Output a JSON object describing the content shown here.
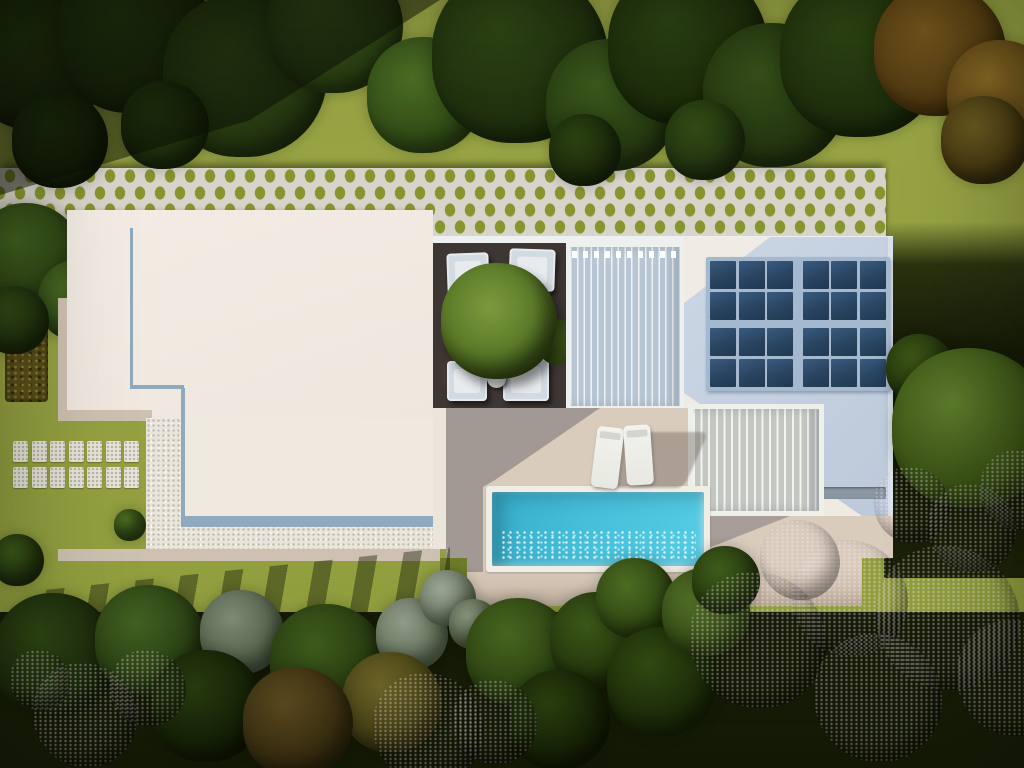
{
  "scene": {
    "description": "Aerial top-down 3D render of a modern flat-roof villa with breeze-block fence, shaded courtyard, slatted pergolas, rooftop solar array, swimming pool with sun loungers, stepping-stone path and landscaped garden with flowering trees",
    "canvas": {
      "width": 1024,
      "height": 768
    },
    "palette": {
      "lawn": "#96a240",
      "lattice": "#d8d4cb",
      "roof_white": "#f1eae1",
      "roof_blue": "#c3cfde",
      "accent": "#8fa9be",
      "solar": "#2c4a69",
      "courtyard": "#3e3633",
      "terrace": "#d9ccbd",
      "terrace_shadow": "#a8a2a7",
      "pool": "#46bfda",
      "coping": "#efede4",
      "gravel": "#e9e5db",
      "beige": "#cfc1b1",
      "blossom": "#cba5c1",
      "sage": "#8e9887",
      "autumn": "#7d5c20"
    },
    "solar_array": {
      "rows": 4,
      "cols": 6,
      "pad": 4,
      "gap": 2.5,
      "center_gap_x": 7,
      "center_gap_y": 6
    },
    "stepping_stones": {
      "rows": 2,
      "cols": 7,
      "cell_w": 15,
      "cell_h": 21,
      "gap_x": 3.5,
      "gap_y": 5
    },
    "furniture": {
      "courtyard_sofas": 4,
      "side_tables": 2,
      "sun_loungers": 2
    },
    "trees": {
      "top": [
        {
          "x": 38,
          "y": 58,
          "r": 72,
          "c": "#2a4012",
          "e": "#16230a"
        },
        {
          "x": 135,
          "y": 35,
          "r": 78,
          "c": "#2e4614",
          "e": "#19270c"
        },
        {
          "x": 245,
          "y": 75,
          "r": 82,
          "c": "#3a5519",
          "e": "#20310f"
        },
        {
          "x": 335,
          "y": 25,
          "r": 68,
          "c": "#42601e",
          "e": "#263a11"
        },
        {
          "x": 425,
          "y": 95,
          "r": 58,
          "c": "#4d7024",
          "e": "#2c4414"
        },
        {
          "x": 520,
          "y": 55,
          "r": 88,
          "c": "#304815",
          "e": "#1b2b0c"
        },
        {
          "x": 612,
          "y": 105,
          "r": 66,
          "c": "#3c5a1c",
          "e": "#223410"
        },
        {
          "x": 688,
          "y": 45,
          "r": 80,
          "c": "#2c4413",
          "e": "#182708"
        },
        {
          "x": 775,
          "y": 95,
          "r": 72,
          "c": "#37511a",
          "e": "#1f2f0e"
        },
        {
          "x": 862,
          "y": 55,
          "r": 82,
          "c": "#2f4714",
          "e": "#1a290b"
        },
        {
          "x": 940,
          "y": 50,
          "r": 66,
          "c": "#7b5a1e",
          "e": "#4a340f"
        },
        {
          "x": 1002,
          "y": 95,
          "r": 55,
          "c": "#8a6a26",
          "e": "#523c12"
        },
        {
          "x": 60,
          "y": 140,
          "r": 48,
          "c": "#24390f",
          "e": "#131d07"
        },
        {
          "x": 165,
          "y": 125,
          "r": 44,
          "c": "#2d4512",
          "e": "#18260a"
        },
        {
          "x": 585,
          "y": 150,
          "r": 36,
          "c": "#2b4212",
          "e": "#18260a"
        },
        {
          "x": 705,
          "y": 140,
          "r": 40,
          "c": "#334c16",
          "e": "#1d2d0d"
        },
        {
          "x": 985,
          "y": 140,
          "r": 44,
          "c": "#6b5a20",
          "e": "#3c300e"
        }
      ],
      "left": [
        {
          "x": 28,
          "y": 258,
          "r": 55,
          "c": "#41601f",
          "e": "#253a10"
        },
        {
          "x": 78,
          "y": 300,
          "r": 40,
          "c": "#4a6c24",
          "e": "#2a4013"
        },
        {
          "x": 15,
          "y": 320,
          "r": 34,
          "c": "#314a16",
          "e": "#1c2c0c"
        },
        {
          "x": 130,
          "y": 525,
          "r": 16,
          "c": "#4e7024",
          "e": "#2c4413"
        },
        {
          "x": 18,
          "y": 560,
          "r": 26,
          "c": "#3c5a1a",
          "e": "#20300d"
        }
      ],
      "right": [
        {
          "x": 920,
          "y": 368,
          "r": 34,
          "c": "#3c5516",
          "e": "#22330c"
        },
        {
          "x": 972,
          "y": 428,
          "r": 80,
          "c": "#5f7e2c",
          "e": "#2f450f"
        }
      ],
      "bottom": [
        {
          "x": 55,
          "y": 655,
          "r": 62,
          "c": "#2e4614",
          "e": "#16220a"
        },
        {
          "x": 150,
          "y": 640,
          "r": 55,
          "c": "#426222",
          "e": "#243710"
        },
        {
          "x": 242,
          "y": 632,
          "r": 42,
          "c": "#7e8a74",
          "e": "#4c5a42"
        },
        {
          "x": 208,
          "y": 706,
          "r": 56,
          "c": "#273d0e",
          "e": "#121b06"
        },
        {
          "x": 328,
          "y": 662,
          "r": 58,
          "c": "#3f5c1c",
          "e": "#22340f"
        },
        {
          "x": 412,
          "y": 634,
          "r": 36,
          "c": "#909b88",
          "e": "#5c6b52"
        },
        {
          "x": 448,
          "y": 598,
          "r": 28,
          "c": "#9aa494",
          "e": "#66755c"
        },
        {
          "x": 474,
          "y": 624,
          "r": 25,
          "c": "#87927c",
          "e": "#525f45"
        },
        {
          "x": 392,
          "y": 702,
          "r": 50,
          "c": "#6e6628",
          "e": "#3e3a12"
        },
        {
          "x": 298,
          "y": 722,
          "r": 55,
          "c": "#5e4c20",
          "e": "#33290e"
        },
        {
          "x": 520,
          "y": 652,
          "r": 54,
          "c": "#48661f",
          "e": "#273b10"
        },
        {
          "x": 598,
          "y": 640,
          "r": 48,
          "c": "#3c5818",
          "e": "#20300c"
        },
        {
          "x": 636,
          "y": 598,
          "r": 40,
          "c": "#4c6c22",
          "e": "#2a3f10"
        },
        {
          "x": 662,
          "y": 682,
          "r": 55,
          "c": "#314a13",
          "e": "#182607"
        },
        {
          "x": 706,
          "y": 612,
          "r": 44,
          "c": "#547228",
          "e": "#2e4412"
        },
        {
          "x": 726,
          "y": 580,
          "r": 34,
          "c": "#3e5c1a",
          "e": "#22330e"
        },
        {
          "x": 560,
          "y": 720,
          "r": 50,
          "c": "#2b420f",
          "e": "#121c05"
        }
      ]
    },
    "blossoms": [
      {
        "x": 85,
        "y": 715,
        "r": 52,
        "c": "#bb90b0",
        "e": "#7b5872"
      },
      {
        "x": 148,
        "y": 688,
        "r": 38,
        "c": "#cfa8c6",
        "e": "#8d6683"
      },
      {
        "x": 40,
        "y": 680,
        "r": 30,
        "c": "#a57b99",
        "e": "#6b4a62"
      },
      {
        "x": 428,
        "y": 728,
        "r": 55,
        "c": "#6b4a5e",
        "e": "#3a2734"
      },
      {
        "x": 495,
        "y": 722,
        "r": 42,
        "c": "#7d5870",
        "e": "#45303e"
      },
      {
        "x": 758,
        "y": 640,
        "r": 68,
        "c": "#cda7c4",
        "e": "#8a6080"
      },
      {
        "x": 850,
        "y": 598,
        "r": 58,
        "c": "#d7b5cf",
        "e": "#97708c"
      },
      {
        "x": 800,
        "y": 560,
        "r": 40,
        "c": "#d9b9d1",
        "e": "#a07a96"
      },
      {
        "x": 948,
        "y": 618,
        "r": 72,
        "c": "#cba4c0",
        "e": "#8a6080"
      },
      {
        "x": 1015,
        "y": 678,
        "r": 58,
        "c": "#c09ab6",
        "e": "#7e5a74"
      },
      {
        "x": 878,
        "y": 698,
        "r": 64,
        "c": "#96708a",
        "e": "#5c4054"
      },
      {
        "x": 912,
        "y": 505,
        "r": 38,
        "c": "#c9a2be",
        "e": "#8a6080"
      },
      {
        "x": 972,
        "y": 528,
        "r": 44,
        "c": "#d3aec9",
        "e": "#936c88"
      },
      {
        "x": 1020,
        "y": 490,
        "r": 40,
        "c": "#c39cb8",
        "e": "#82607a"
      }
    ]
  }
}
